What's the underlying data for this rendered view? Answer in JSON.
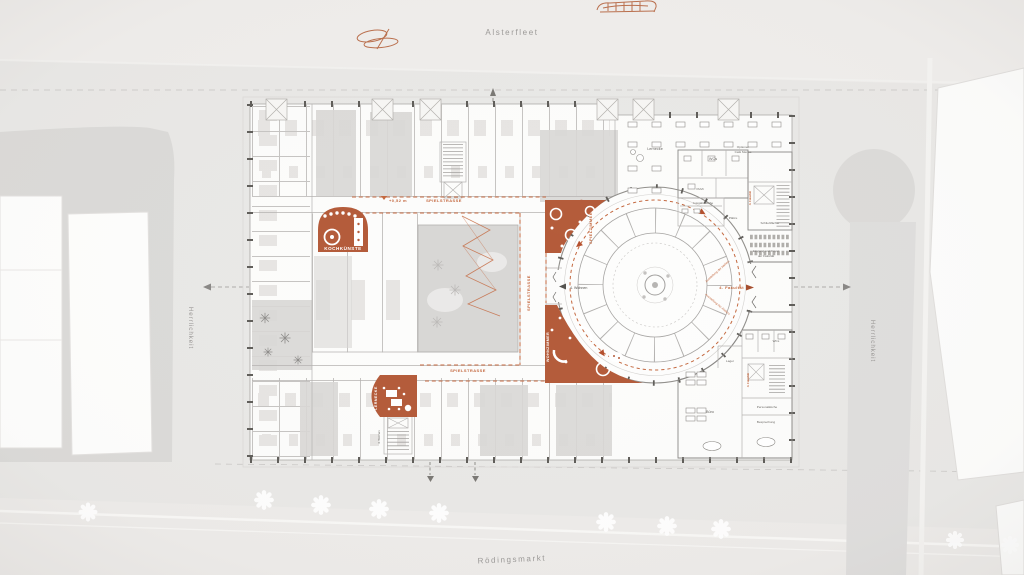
{
  "streets": {
    "north": "Alsterfleet",
    "south": "Rödingsmarkt",
    "west": "Herrlichkeit",
    "east": "Herrlichkeit"
  },
  "corridor": {
    "name_top": "SPIELSTRASSE",
    "name_mid": "SPIELSTRASSE",
    "name_bottom": "SPIELSTRASSE",
    "elevation_mark": "+0,52 m"
  },
  "rooms": {
    "kochkuenste": "KOCHKÜNSTE",
    "spielzimmer": "SPIELZIMMER",
    "lernecke_orange": "LERNECKE",
    "wohnzimmer": "WOHNZIMMER",
    "lernecke_cafe": "Lernecke",
    "cafe_line1": "Optionen",
    "cafe_line2": "Café Mensa",
    "wcs_north": "WCs",
    "pumi": "PuMi",
    "ausgabekueche": "Ausgabeküche",
    "plaetze": "Plätze",
    "schliessfaecher": "Schließfächer",
    "foyer_line1": "Eingang und Foyer",
    "foyer_line2": "der Fakultät",
    "wcs_south": "WCs",
    "lager": "Lager",
    "personalkueche": "Personalküche",
    "buero": "Büro",
    "besprechung": "Besprechung"
  },
  "circulation": {
    "axis_west": "4. Wohnen",
    "axis_east": "4. Fakultät",
    "stair_ne": "4. Fakultät",
    "stair_se": "4. Fakultät",
    "stair_sw": "4. Wohnen",
    "rotunda_note_upper": "Ausstellung der Ateliers",
    "rotunda_note_lower": "Ausstellung der Ateliers"
  },
  "colors": {
    "accent": "#b45b3a",
    "accent_deep": "#a64e2e",
    "accent_line": "#c4683f",
    "paper": "#e9e8e6",
    "street": "#efedeb",
    "block": "#dbdad8",
    "building": "#fcfcfb",
    "courtyard": "#d8d7d5",
    "wall": "#8a8886",
    "wall_light": "#b5b3b1",
    "label": "#9b9997",
    "ink": "#55534f"
  }
}
